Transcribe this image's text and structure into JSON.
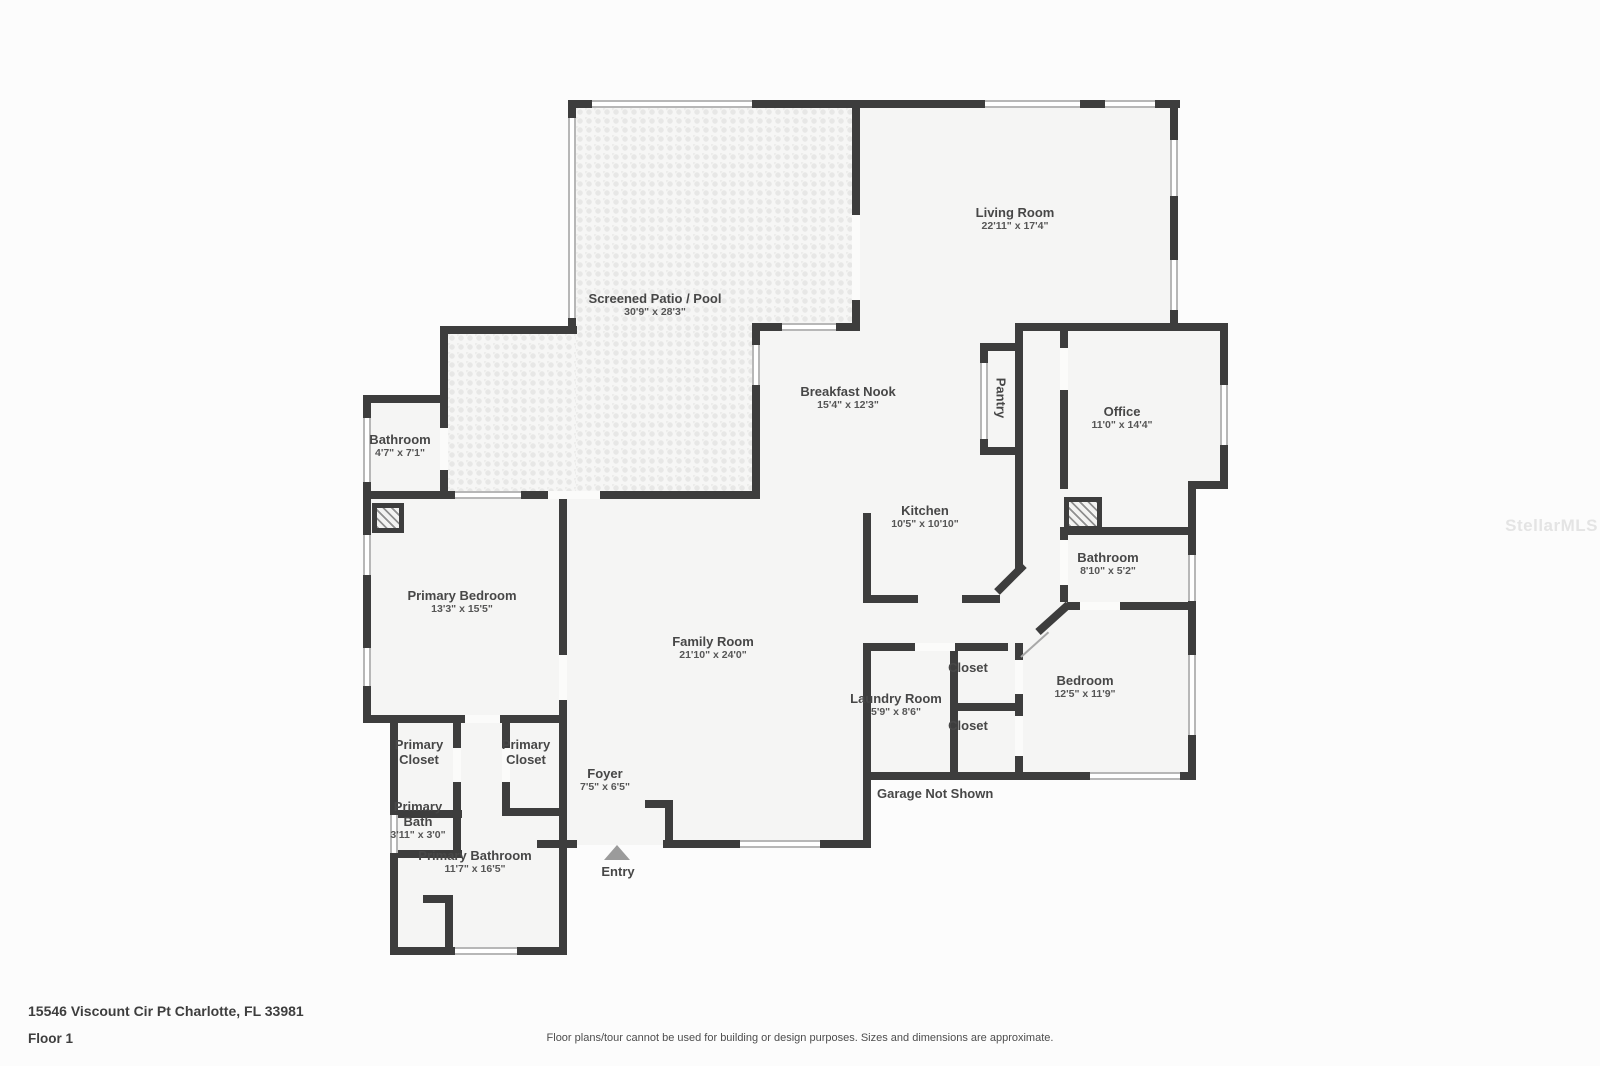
{
  "footer": {
    "address": "15546 Viscount Cir Pt Charlotte, FL 33981",
    "floor": "Floor 1",
    "disclaimer": "Floor plans/tour cannot be used for building or design purposes. Sizes and dimensions are approximate."
  },
  "watermark": "StellarMLS",
  "annotations": {
    "garage": "Garage Not Shown",
    "entry": "Entry"
  },
  "rooms": {
    "living_room": {
      "name": "Living Room",
      "dims": "22'11\" x 17'4\""
    },
    "screened_patio": {
      "name": "Screened Patio / Pool",
      "dims": "30'9\" x 28'3\""
    },
    "breakfast_nook": {
      "name": "Breakfast Nook",
      "dims": "15'4\" x 12'3\""
    },
    "pantry": {
      "name": "Pantry",
      "dims": ""
    },
    "office": {
      "name": "Office",
      "dims": "11'0\" x 14'4\""
    },
    "kitchen": {
      "name": "Kitchen",
      "dims": "10'5\" x 10'10\""
    },
    "bathroom_left": {
      "name": "Bathroom",
      "dims": "4'7\" x 7'1\""
    },
    "bathroom_right": {
      "name": "Bathroom",
      "dims": "8'10\" x 5'2\""
    },
    "primary_bedroom": {
      "name": "Primary Bedroom",
      "dims": "13'3\" x 15'5\""
    },
    "family_room": {
      "name": "Family Room",
      "dims": "21'10\" x 24'0\""
    },
    "laundry_room": {
      "name": "Laundry Room",
      "dims": "5'9\" x 8'6\""
    },
    "closet_top": {
      "name": "Closet",
      "dims": ""
    },
    "closet_bottom": {
      "name": "Closet",
      "dims": ""
    },
    "bedroom": {
      "name": "Bedroom",
      "dims": "12'5\" x 11'9\""
    },
    "primary_closet_left": {
      "name": "Primary Closet",
      "dims": ""
    },
    "primary_closet_right": {
      "name": "Primary Closet",
      "dims": ""
    },
    "primary_bath": {
      "name": "Primary Bath",
      "dims": "3'11\" x 3'0\""
    },
    "primary_bathroom": {
      "name": "Primary Bathroom",
      "dims": "11'7\" x 16'5\""
    },
    "foyer": {
      "name": "Foyer",
      "dims": "7'5\" x 6'5\""
    }
  },
  "colors": {
    "wall": "#3d3d3d",
    "floor": "#f5f5f4",
    "window_frame": "#b7b7b7",
    "entry_arrow": "#9b9b9b",
    "label_text": "#474747",
    "watermark_text": "#e4e4e4"
  }
}
